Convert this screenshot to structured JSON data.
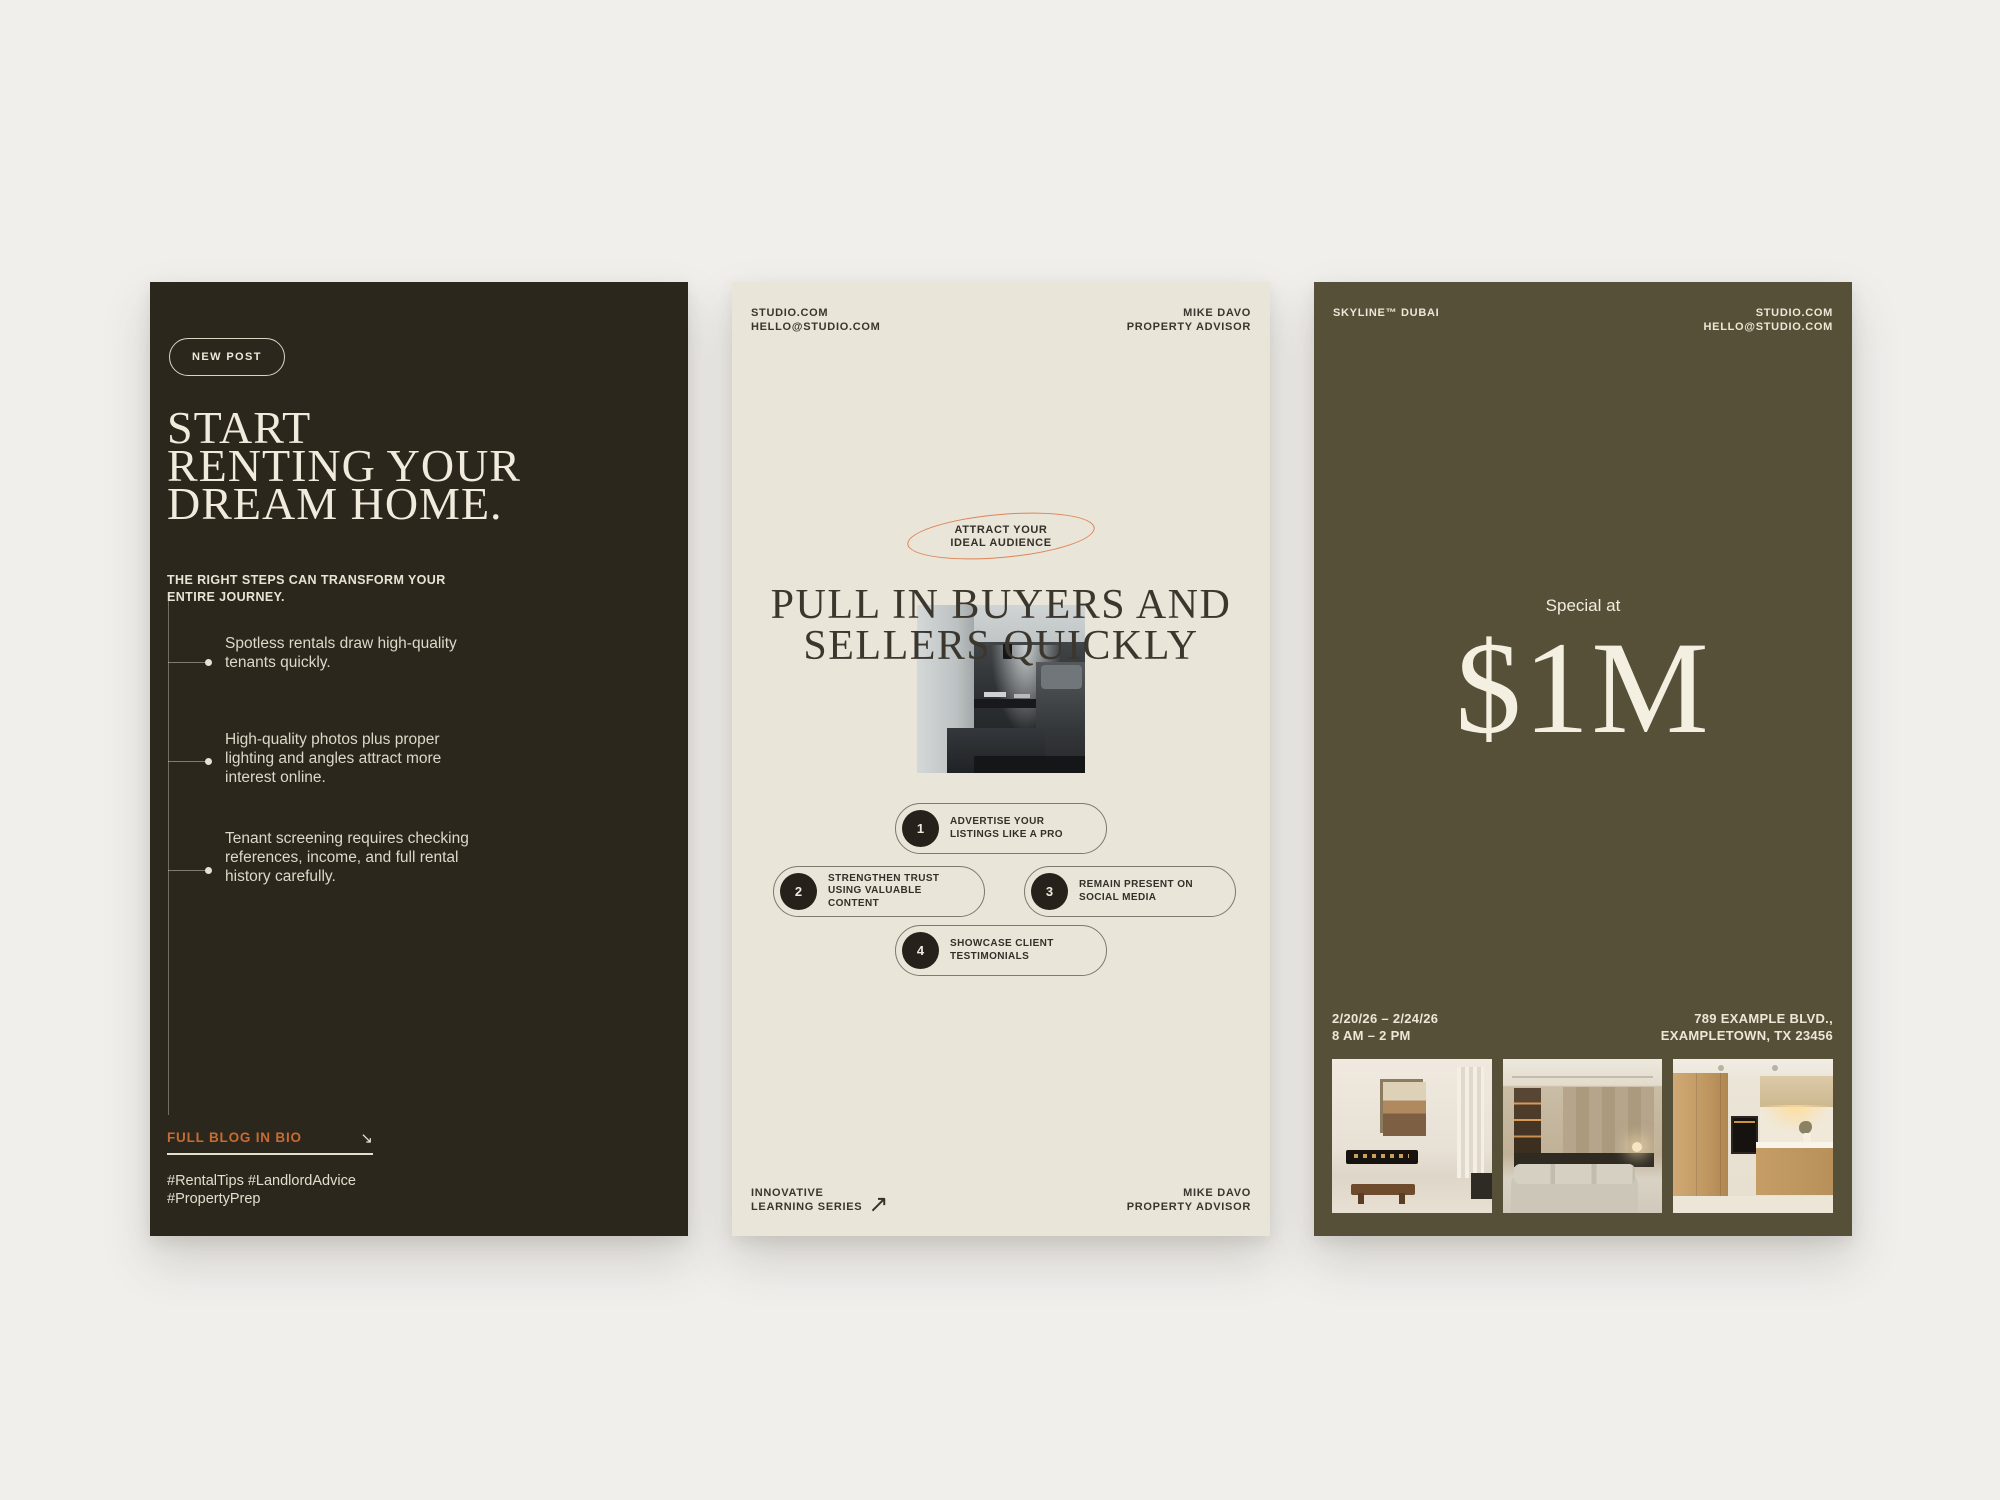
{
  "page": {
    "background": "#f0efec"
  },
  "colors": {
    "card1_bg": "#2b271c",
    "card2_bg": "#e9e5d8",
    "card3_bg": "#565039",
    "cream_text": "#ece7d6",
    "ink_text": "#35322b",
    "accent_orange": "#c76b33",
    "ellipse_orange": "#dd7e51"
  },
  "card1": {
    "badge": "NEW POST",
    "headline_lines": [
      "START",
      "RENTING YOUR",
      "DREAM HOME."
    ],
    "subhead_lines": [
      "THE RIGHT STEPS CAN TRANSFORM YOUR",
      "ENTIRE JOURNEY."
    ],
    "bullets": [
      "Spotless rentals draw high-quality tenants quickly.",
      "High-quality photos plus proper lighting and angles attract more interest online.",
      "Tenant screening requires checking references, income, and full rental history carefully."
    ],
    "cta_label": "FULL BLOG IN BIO",
    "cta_arrow": "↘",
    "hashtag_lines": [
      "#RentalTips #LandlordAdvice",
      "#PropertyPrep"
    ]
  },
  "card2": {
    "header_left_lines": [
      "STUDIO.COM",
      "HELLO@STUDIO.COM"
    ],
    "header_right_lines": [
      "MIKE DAVO",
      "PROPERTY ADVISOR"
    ],
    "badge_lines": [
      "ATTRACT YOUR",
      "IDEAL AUDIENCE"
    ],
    "headline_lines": [
      "PULL IN BUYERS AND",
      "SELLERS QUICKLY"
    ],
    "steps": [
      {
        "num": "1",
        "label": "ADVERTISE YOUR LISTINGS LIKE A PRO"
      },
      {
        "num": "2",
        "label": "STRENGTHEN TRUST USING VALUABLE CONTENT"
      },
      {
        "num": "3",
        "label": "REMAIN PRESENT ON SOCIAL MEDIA"
      },
      {
        "num": "4",
        "label": "SHOWCASE CLIENT TESTIMONIALS"
      }
    ],
    "footer_left_lines": [
      "INNOVATIVE",
      "LEARNING SERIES"
    ],
    "footer_arrow": "↗",
    "footer_right_lines": [
      "MIKE DAVO",
      "PROPERTY ADVISOR"
    ]
  },
  "card3": {
    "header_left": "SKYLINE™ DUBAI",
    "header_right_lines": [
      "STUDIO.COM",
      "HELLO@STUDIO.COM"
    ],
    "price_label": "Special at",
    "price": "$1M",
    "dates_lines": [
      "2/20/26 – 2/24/26",
      "8 AM – 2 PM"
    ],
    "address_lines": [
      "789 EXAMPLE BLVD.,",
      "EXAMPLETOWN, TX 23456"
    ]
  }
}
